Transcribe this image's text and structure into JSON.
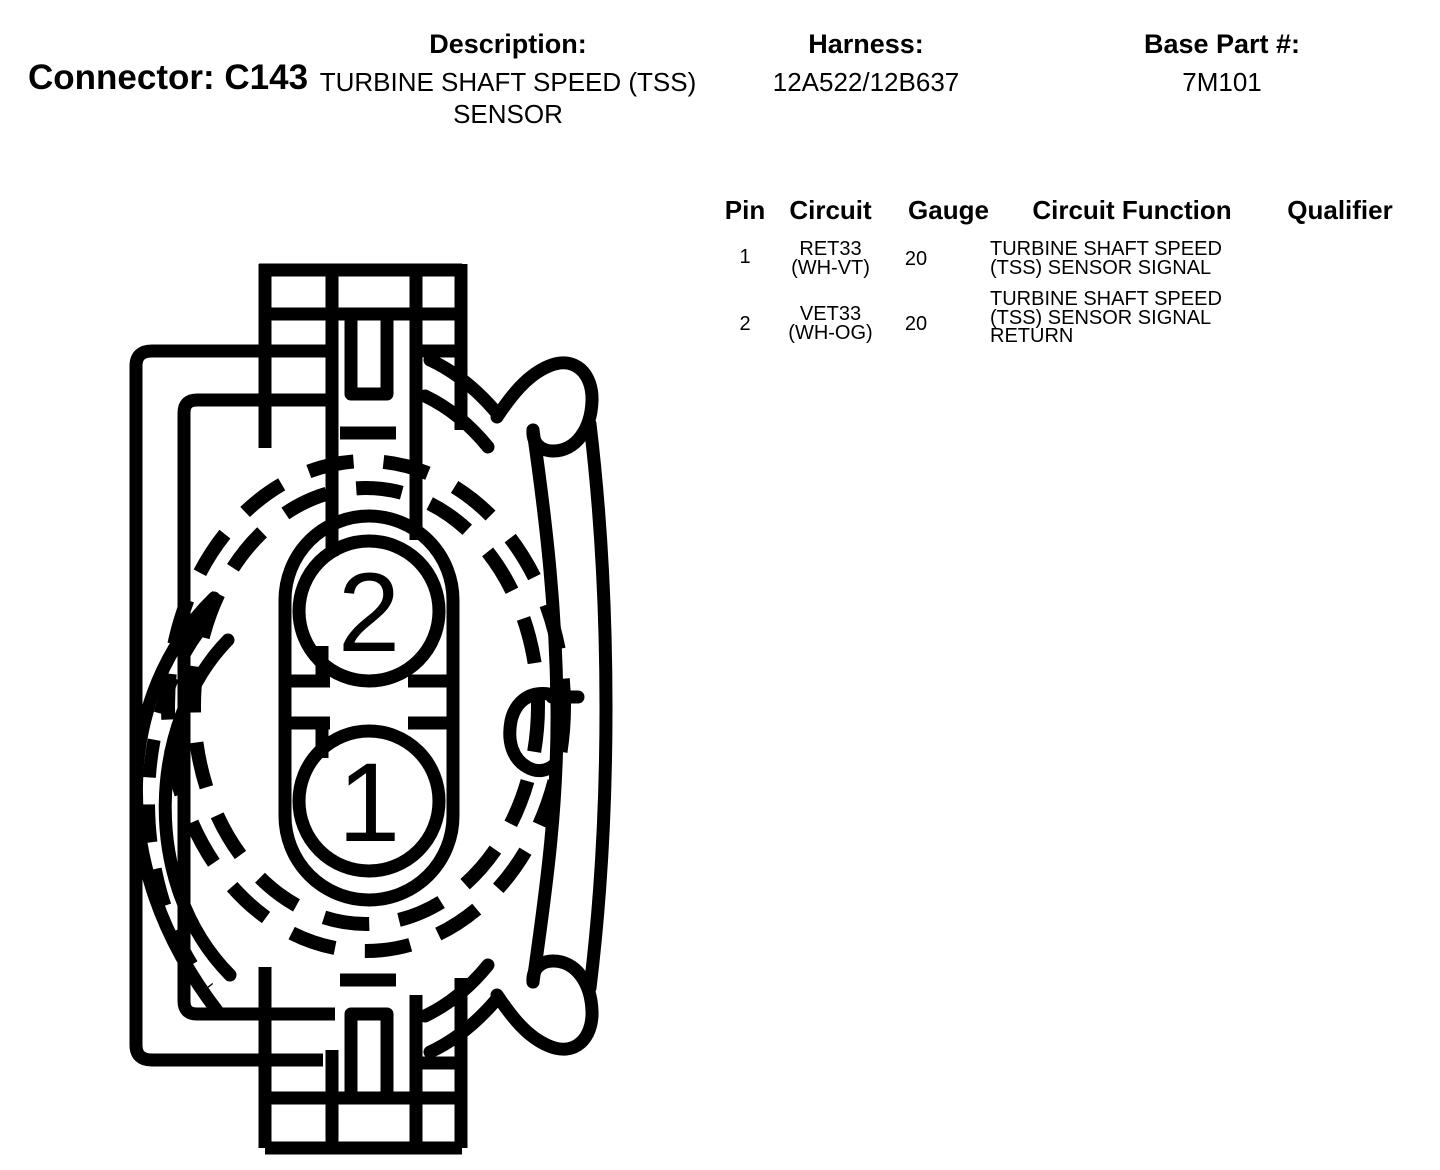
{
  "header": {
    "connector_title": "Connector: C143",
    "description_label": "Description:",
    "description_value": "TURBINE SHAFT SPEED (TSS) SENSOR",
    "harness_label": "Harness:",
    "harness_value": "12A522/12B637",
    "base_part_label": "Base Part #:",
    "base_part_value": "7M101"
  },
  "pin_table": {
    "headers": {
      "pin": "Pin",
      "circuit": "Circuit",
      "gauge": "Gauge",
      "function": "Circuit Function",
      "qualifier": "Qualifier"
    },
    "rows": [
      {
        "pin": "1",
        "circuit_name": "RET33",
        "circuit_color": "(WH-VT)",
        "gauge": "20",
        "function": "TURBINE SHAFT SPEED (TSS) SENSOR SIGNAL",
        "qualifier": ""
      },
      {
        "pin": "2",
        "circuit_name": "VET33",
        "circuit_color": "(WH-OG)",
        "gauge": "20",
        "function": "TURBINE SHAFT SPEED (TSS) SENSOR SIGNAL RETURN",
        "qualifier": ""
      }
    ]
  },
  "diagram": {
    "pin_labels": [
      "2",
      "1"
    ],
    "line_color": "#000000",
    "background": "#ffffff"
  }
}
